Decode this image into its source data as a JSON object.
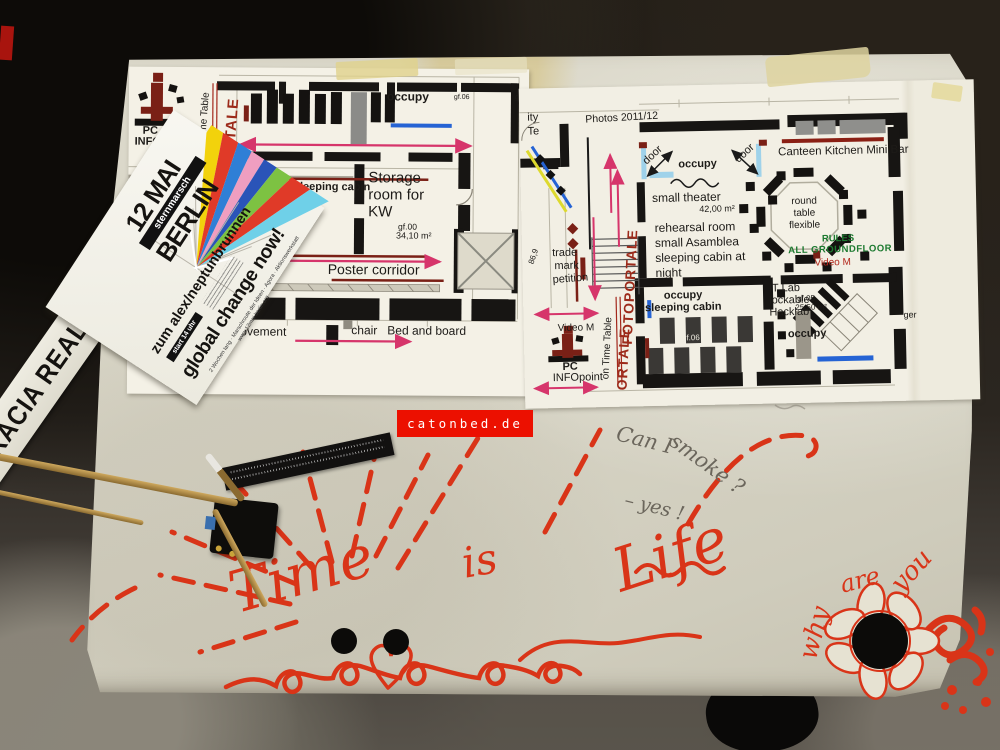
{
  "photo": {
    "credit": "catonbed.de"
  },
  "floor_tape": {
    "text": "OCRACIA REAL YA"
  },
  "flyer": {
    "date": "12 MAI",
    "march_type": "sternmarsch",
    "city": "BERLIN",
    "destination": "zum alex/neptunbrunnen",
    "start_time": "start 14 uhr",
    "slogan": "global change now!",
    "details": "2 Wochen lang · Marschroute der Ideen · Agora · Aktionswerkstatt",
    "url": "www.12mai-berlin.org",
    "ray_colors": [
      "#f2d20c",
      "#e03a28",
      "#2f7fd6",
      "#ef9ec0",
      "#2a54b8",
      "#7dc242",
      "#e03a28",
      "#6fd0e8"
    ]
  },
  "plan_left": {
    "pc_line1": "PC",
    "pc_line2": "INFO",
    "on_time_table": "on Time Table",
    "fotoportale": "FOTOPORTALE",
    "occupy_top": "occupy",
    "gf06_top": "gf.06",
    "occupy_cabin": "occupy sleeping cabin",
    "storage_1": "Storage",
    "storage_2": "room for",
    "storage_3": "KW",
    "storage_gf": "gf.00",
    "storage_area": "34,10 m²",
    "poster_corridor": "Poster corridor",
    "movement": "movement",
    "chair_bed": "chair   Bed and board",
    "frag_wi": ", wi",
    "frag_sound": "sound",
    "frag_ge": "ge"
  },
  "plan_right": {
    "frag_ity": "ity",
    "frag_te": "Te",
    "frag_ger": "ger",
    "photos": "Photos 2011/12",
    "door": "door",
    "occupy_doors": "occupy",
    "small_theater": "small theater",
    "theater_area": "42,00 m²",
    "rehearsal": "rehearsal room",
    "asamblea": "small Asamblea",
    "sleeping_1": "sleeping cabin at",
    "sleeping_2": "night",
    "canteen": "Canteen Kitchen Mini Bar",
    "round_1": "round",
    "round_2": "table",
    "round_3": "flexible",
    "rules_1": "RULES",
    "rules_2": "ALL GROUNDFLOOR",
    "video_m": "Video M",
    "it_lab_1": "IT Lab",
    "it_lab_2": "lockable",
    "it_lab_3": "Hacklab",
    "it_gf": "gf.05",
    "it_area": "25,50 m²",
    "occupy_it": "occupy",
    "occupy_cabin_1": "occupy",
    "occupy_cabin_2": "sleeping cabin",
    "cabin_gf": "gf.06",
    "trade_1": "trade",
    "trade_2": "mark",
    "trade_3": "petition",
    "level_num": "86,9",
    "pc_line1": "PC",
    "pc_line2": "INFOpoint",
    "on_time_table": "on Time Table",
    "fotoportale": "FOTOPORTALE",
    "ortale": "ORTALE"
  },
  "handwriting": {
    "q1": "Can I",
    "q2": "smoke ?",
    "answer": "– yes !",
    "time": "Time",
    "is": "is",
    "life": "Life",
    "why": "why",
    "are": "are",
    "you": "you"
  },
  "colors": {
    "marker_red": "#d93418",
    "plan_magenta": "#d6356b",
    "plan_maroon": "#7a2016",
    "plan_blue": "#2563d4",
    "rules_green": "#1d7a30",
    "watermark_bg": "#ec1000"
  }
}
